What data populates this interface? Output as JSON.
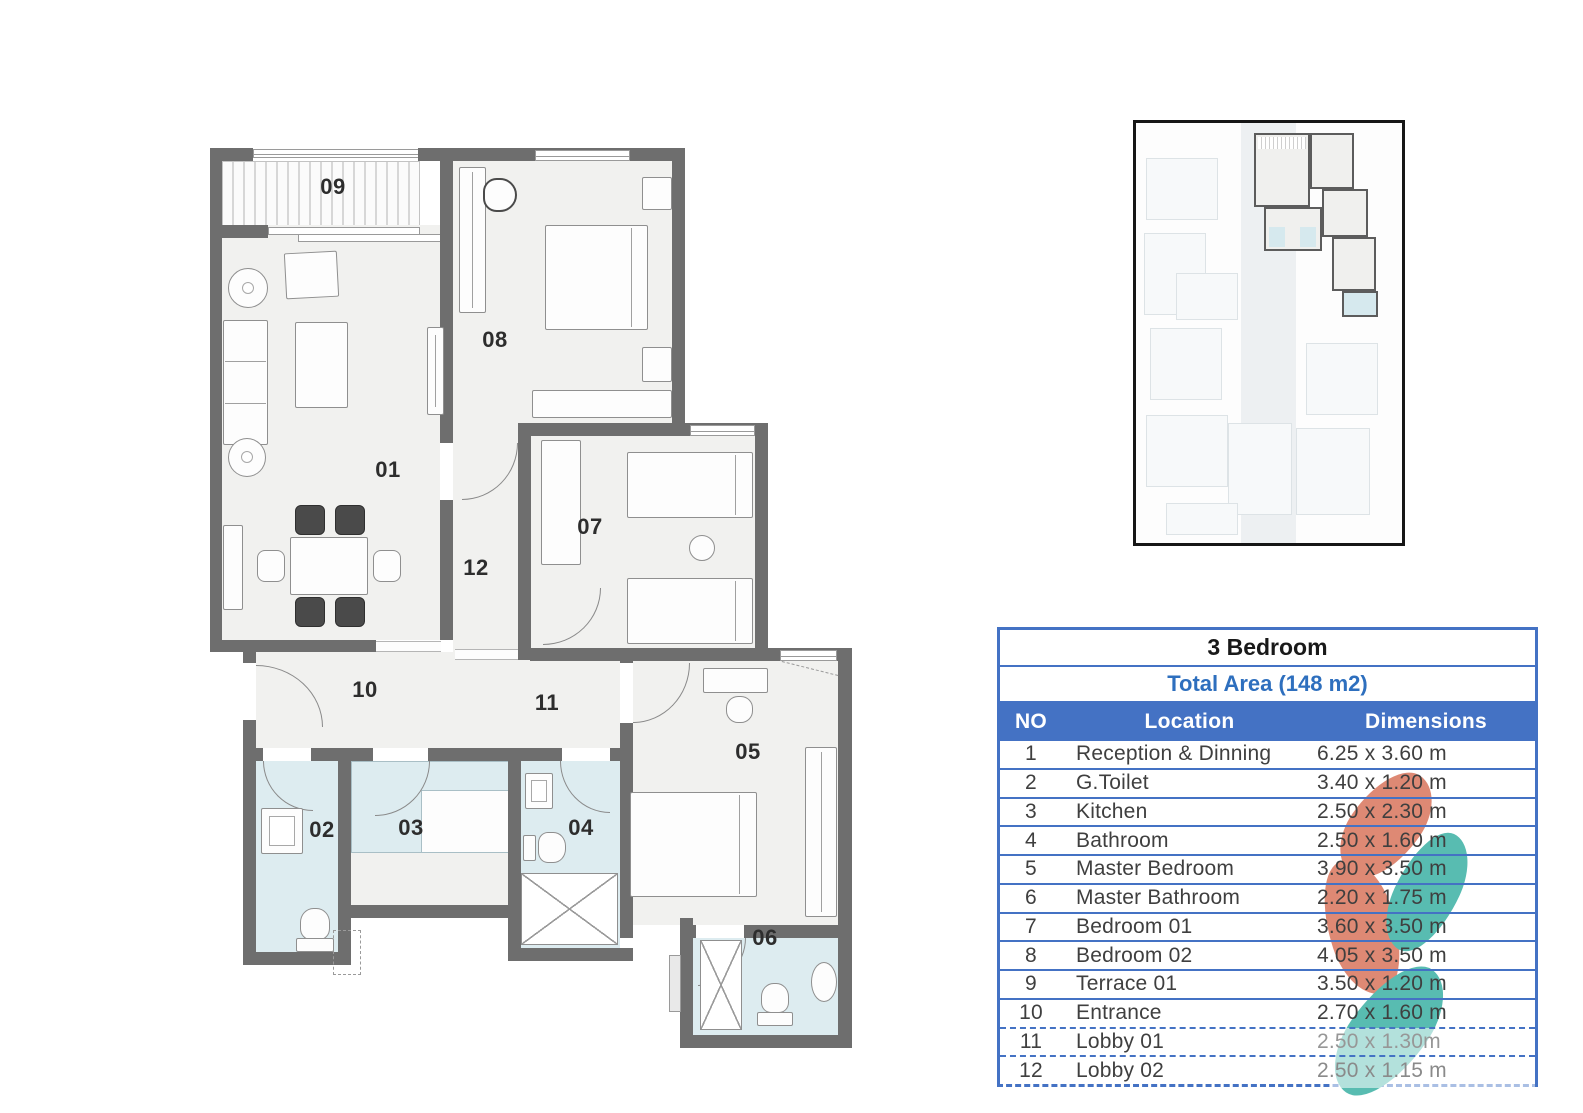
{
  "plan": {
    "room_labels": [
      "01",
      "02",
      "03",
      "04",
      "05",
      "06",
      "07",
      "08",
      "09",
      "10",
      "11",
      "12"
    ]
  },
  "table": {
    "title": "3 Bedroom",
    "subtitle": "Total Area (148 m2)",
    "columns": {
      "no": "NO",
      "location": "Location",
      "dimensions": "Dimensions"
    },
    "rows": [
      {
        "no": "1",
        "location": "Reception & Dinning",
        "dimensions": "6.25 x 3.60 m"
      },
      {
        "no": "2",
        "location": "G.Toilet",
        "dimensions": "3.40 x 1.20 m"
      },
      {
        "no": "3",
        "location": "Kitchen",
        "dimensions": "2.50 x 2.30 m"
      },
      {
        "no": "4",
        "location": "Bathroom",
        "dimensions": "2.50 x 1.60 m"
      },
      {
        "no": "5",
        "location": "Master Bedroom",
        "dimensions": "3.90 x 3.50 m"
      },
      {
        "no": "6",
        "location": "Master Bathroom",
        "dimensions": "2.20 x 1.75 m"
      },
      {
        "no": "7",
        "location": "Bedroom 01",
        "dimensions": "3.60 x 3.50 m"
      },
      {
        "no": "8",
        "location": "Bedroom 02",
        "dimensions": "4.05 x 3.50 m"
      },
      {
        "no": "9",
        "location": "Terrace 01",
        "dimensions": "3.50 x 1.20 m"
      },
      {
        "no": "10",
        "location": "Entrance",
        "dimensions": "2.70 x 1.60 m"
      },
      {
        "no": "11",
        "location": "Lobby 01",
        "dimensions": "2.50 x 1.30m"
      },
      {
        "no": "12",
        "location": "Lobby 02",
        "dimensions": "2.50 x 1.15 m"
      }
    ]
  },
  "colors": {
    "table_blue": "#4472c4",
    "wall_gray": "#6e6e6e",
    "wet_room_blue": "#ddecf0",
    "watermark_salmon": "#de8974",
    "watermark_teal": "#58bcb1"
  }
}
